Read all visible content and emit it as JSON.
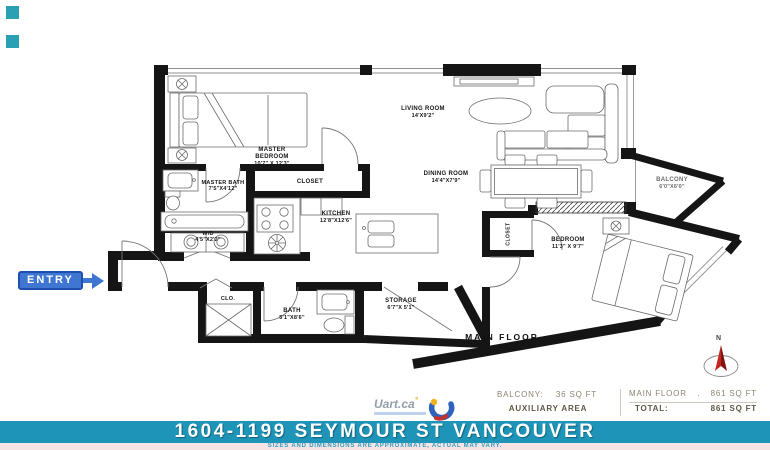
{
  "entry": {
    "label": "ENTRY"
  },
  "rooms": {
    "master_bedroom": {
      "name": "MASTER BEDROOM",
      "dims": "10'7\" X 12'3\""
    },
    "master_bath": {
      "name": "MASTER BATH",
      "dims": "7'5\"X4'12\""
    },
    "master_closet": {
      "name": "CLOSET",
      "dims": ""
    },
    "wd": {
      "name": "W/D",
      "dims": "4'5\"X2'2\""
    },
    "kitchen": {
      "name": "KITCHEN",
      "dims": "12'8\"X12'6\""
    },
    "living_room": {
      "name": "LIVING ROOM",
      "dims": "14'X9'2\""
    },
    "dining_room": {
      "name": "DINING ROOM",
      "dims": "14'4\"X7'9\""
    },
    "bedroom": {
      "name": "BEDROOM",
      "dims": "11'3\" X 9'7\""
    },
    "bedroom_closet": {
      "name": "CLOSET",
      "dims": ""
    },
    "balcony": {
      "name": "BALCONY",
      "dims": "6'0\"X6'0\""
    },
    "clo": {
      "name": "CLO.",
      "dims": ""
    },
    "bath": {
      "name": "BATH",
      "dims": "5'1\"X8'6\""
    },
    "storage": {
      "name": "STORAGE",
      "dims": "6'7\"X 5'1\""
    }
  },
  "plan": {
    "floor_label": "MAIN FLOOR",
    "compass": "N"
  },
  "footer": {
    "logo_text": "Uart.ca",
    "balcony_label": "BALCONY:",
    "balcony_value": "36 SQ FT",
    "auxiliary_label": "AUXILIARY AREA",
    "main_floor_label": "MAIN FLOOR",
    "main_floor_separator": ".",
    "main_floor_value": "861 SQ FT",
    "total_label": "TOTAL:",
    "total_value": "861 SQ FT"
  },
  "title_bar": {
    "address": "1604-1199 SEYMOUR ST VANCOUVER",
    "disclaimer": "SIZES AND DIMENSIONS ARE APPROXIMATE, ACTUAL MAY VARY."
  },
  "colors": {
    "bar_teal": "#1e95b8",
    "entry_blue": "#3f76d2",
    "compass_red": "#c3271e",
    "strip_pink": "#f7e3e3"
  }
}
